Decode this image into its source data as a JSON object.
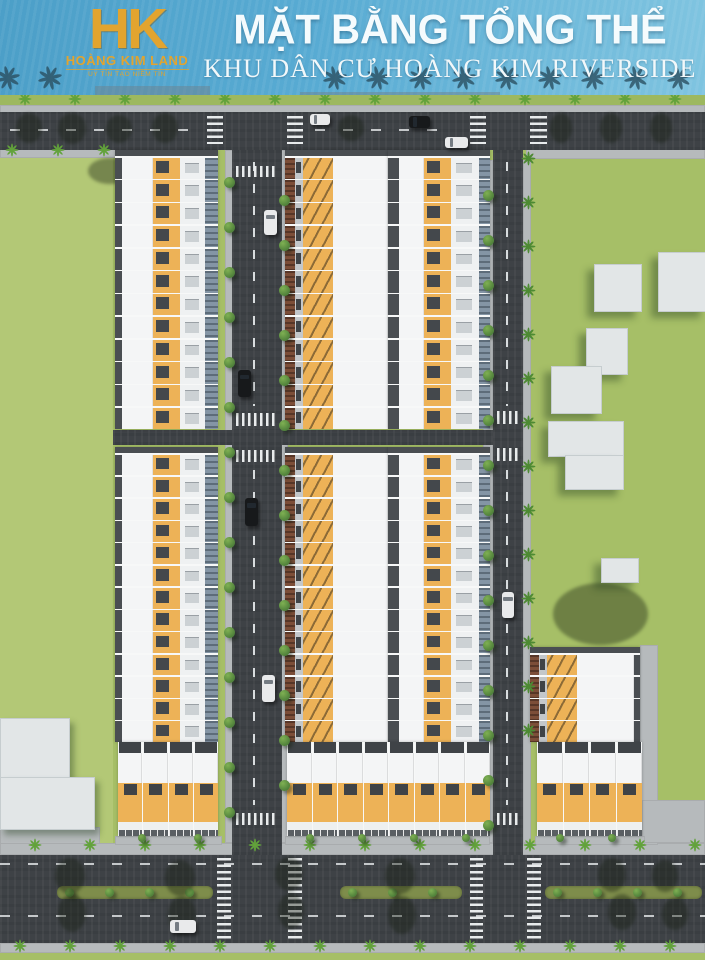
{
  "header": {
    "logo": {
      "monogram": "HK",
      "company": "HOÀNG KIM LAND",
      "tagline": "UY TÍN TẠO NIỀM TIN"
    },
    "title": "MẶT BẰNG TỔNG THỂ",
    "subtitle": "KHU DÂN CƯ HOÀNG KIM RIVERSIDE"
  },
  "palette": {
    "banner_blue": "#58abd3",
    "logo_gold": "#e2a42f",
    "title_white": "#f5fbfd",
    "grass": "#a6bf67",
    "road": "#3e4246",
    "sidewalk": "#b6babc",
    "roof_white": "#f4f5f6",
    "roof_orange": "#edb257",
    "roof_dark": "#4a4e52",
    "awning_blue": "#8495a5",
    "facade_brown": "#7c4e38",
    "building_white": "#e2e6e7",
    "median_green": "#7e8d4b",
    "tree_green": "#4d8a33",
    "car_light": "#e9eaeb",
    "car_dark": "#17191b"
  },
  "scene": {
    "grass_tints": [
      [
        0,
        95,
        705,
        12,
        "#9db85f"
      ],
      [
        0,
        158,
        113,
        686,
        "rgba(240,245,190,0.18)"
      ]
    ],
    "sidewalks": [
      [
        0,
        105,
        705,
        8
      ],
      [
        0,
        148,
        118,
        10
      ],
      [
        526,
        148,
        179,
        11
      ],
      [
        225,
        150,
        8,
        693
      ],
      [
        280,
        150,
        8,
        693
      ],
      [
        483,
        160,
        10,
        683
      ],
      [
        523,
        160,
        8,
        683
      ],
      [
        0,
        843,
        705,
        12
      ],
      [
        0,
        943,
        705,
        10
      ],
      [
        640,
        645,
        18,
        200
      ],
      [
        642,
        800,
        63,
        43
      ],
      [
        0,
        827,
        100,
        17
      ],
      [
        115,
        836,
        107,
        9
      ],
      [
        285,
        836,
        205,
        9
      ],
      [
        535,
        836,
        110,
        9
      ]
    ],
    "roads": [
      [
        0,
        112,
        705,
        38
      ],
      [
        232,
        150,
        50,
        705
      ],
      [
        493,
        150,
        30,
        705
      ],
      [
        113,
        430,
        380,
        15
      ],
      [
        0,
        855,
        705,
        88
      ]
    ],
    "medians": [
      [
        57,
        886,
        156,
        13
      ],
      [
        340,
        886,
        122,
        13
      ],
      [
        545,
        886,
        157,
        13
      ]
    ],
    "median_tree_step": 40,
    "cross_h": [
      [
        207,
        116,
        16,
        28
      ],
      [
        287,
        116,
        16,
        28
      ],
      [
        470,
        116,
        16,
        28
      ],
      [
        530,
        116,
        17,
        28
      ],
      [
        217,
        858,
        14,
        82
      ],
      [
        288,
        858,
        14,
        82
      ],
      [
        470,
        858,
        13,
        82
      ],
      [
        527,
        858,
        14,
        82
      ]
    ],
    "cross_v": [
      [
        236,
        166,
        42,
        11
      ],
      [
        236,
        413,
        42,
        13
      ],
      [
        236,
        450,
        42,
        12
      ],
      [
        236,
        813,
        42,
        12
      ],
      [
        497,
        411,
        24,
        13
      ],
      [
        497,
        448,
        24,
        13
      ],
      [
        497,
        813,
        24,
        12
      ]
    ],
    "dashes_v": [
      [
        253,
        162,
        2,
        244
      ],
      [
        253,
        470,
        2,
        335
      ],
      [
        506,
        162,
        2,
        244
      ],
      [
        506,
        470,
        2,
        335
      ]
    ],
    "dashes_h": [
      [
        10,
        129,
        190,
        2
      ],
      [
        315,
        129,
        140,
        2
      ],
      [
        0,
        863,
        705,
        2
      ],
      [
        0,
        915,
        705,
        2
      ]
    ],
    "row_kinds": {
      "faceE": [
        [
          "dark",
          7
        ],
        [
          "white",
          31
        ],
        [
          "osky",
          27
        ],
        [
          "front",
          25
        ],
        [
          "awn",
          13
        ]
      ],
      "faceW": [
        [
          "brown",
          10
        ],
        [
          "entry",
          8
        ],
        [
          "ox",
          30
        ],
        [
          "white",
          55
        ]
      ],
      "faceE2": [
        [
          "dark",
          11
        ],
        [
          "white",
          25
        ],
        [
          "osky",
          27
        ],
        [
          "front",
          28
        ],
        [
          "awn",
          11
        ]
      ],
      "faceW2": [
        [
          "brown",
          9
        ],
        [
          "entry",
          8
        ],
        [
          "ox",
          30
        ],
        [
          "white",
          57
        ],
        [
          "dark",
          6
        ]
      ]
    },
    "blocks": [
      {
        "x": 115,
        "y": 150,
        "w": 103,
        "h": 279,
        "rows": 12,
        "kind": "faceE"
      },
      {
        "x": 115,
        "y": 447,
        "w": 103,
        "h": 295,
        "rows": 13,
        "kind": "faceE"
      },
      {
        "x": 285,
        "y": 150,
        "w": 103,
        "h": 279,
        "rows": 12,
        "kind": "faceW"
      },
      {
        "x": 285,
        "y": 447,
        "w": 103,
        "h": 295,
        "rows": 13,
        "kind": "faceW"
      },
      {
        "x": 388,
        "y": 150,
        "w": 102,
        "h": 279,
        "rows": 12,
        "kind": "faceE2"
      },
      {
        "x": 388,
        "y": 447,
        "w": 102,
        "h": 295,
        "rows": 13,
        "kind": "faceE2"
      },
      {
        "x": 530,
        "y": 647,
        "w": 110,
        "h": 95,
        "rows": 4,
        "kind": "faceW2"
      }
    ],
    "south_rows": [
      {
        "x": 118,
        "y": 742,
        "w": 100,
        "houses": 4
      },
      {
        "x": 287,
        "y": 742,
        "w": 203,
        "houses": 8
      },
      {
        "x": 537,
        "y": 742,
        "w": 105,
        "houses": 4
      }
    ],
    "buildings": [
      [
        594,
        264,
        46,
        46
      ],
      [
        658,
        252,
        47,
        58
      ],
      [
        586,
        328,
        40,
        45
      ],
      [
        551,
        366,
        49,
        46
      ],
      [
        548,
        421,
        74,
        34
      ],
      [
        565,
        455,
        57,
        33
      ],
      [
        601,
        558,
        36,
        23
      ],
      [
        0,
        718,
        68,
        62
      ],
      [
        0,
        777,
        93,
        51
      ]
    ],
    "cars": [
      [
        310,
        114,
        20,
        11,
        "light"
      ],
      [
        409,
        116,
        21,
        12,
        "dark"
      ],
      [
        445,
        137,
        23,
        11,
        "light"
      ],
      [
        264,
        210,
        13,
        25,
        "light"
      ],
      [
        238,
        370,
        13,
        27,
        "dark"
      ],
      [
        245,
        498,
        13,
        28,
        "dark"
      ],
      [
        262,
        675,
        13,
        27,
        "light"
      ],
      [
        502,
        592,
        12,
        26,
        "light"
      ],
      [
        170,
        920,
        26,
        13,
        "light"
      ]
    ],
    "tree_cols": [
      [
        229,
        182,
        812,
        45,
        "round"
      ],
      [
        284,
        200,
        825,
        45,
        "round"
      ],
      [
        488,
        195,
        825,
        45,
        "round"
      ],
      [
        528,
        158,
        738,
        44,
        "palm"
      ]
    ],
    "tree_rows": [
      [
        99,
        25,
        695,
        50,
        "palm"
      ],
      [
        845,
        35,
        695,
        55,
        "palm"
      ],
      [
        946,
        20,
        700,
        50,
        "palm"
      ],
      [
        150,
        12,
        104,
        46,
        "palm"
      ]
    ],
    "front_trees": [
      [
        142,
        838
      ],
      [
        198,
        838
      ],
      [
        310,
        838
      ],
      [
        362,
        838
      ],
      [
        414,
        838
      ],
      [
        466,
        838
      ],
      [
        560,
        838
      ],
      [
        612,
        838
      ]
    ],
    "shadows": [
      [
        16,
        113,
        26,
        30
      ],
      [
        58,
        113,
        28,
        31
      ],
      [
        106,
        115,
        26,
        28
      ],
      [
        152,
        113,
        26,
        30
      ],
      [
        338,
        115,
        26,
        26
      ],
      [
        550,
        113,
        22,
        30
      ],
      [
        600,
        113,
        22,
        30
      ],
      [
        650,
        113,
        22,
        30
      ],
      [
        55,
        858,
        30,
        36
      ],
      [
        165,
        860,
        30,
        36
      ],
      [
        275,
        857,
        28,
        34
      ],
      [
        385,
        858,
        30,
        36
      ],
      [
        58,
        894,
        28,
        38
      ],
      [
        168,
        896,
        28,
        38
      ],
      [
        278,
        893,
        26,
        36
      ],
      [
        388,
        896,
        28,
        38
      ],
      [
        598,
        858,
        28,
        34
      ],
      [
        652,
        860,
        26,
        32
      ],
      [
        608,
        894,
        28,
        36
      ],
      [
        662,
        898,
        26,
        32
      ],
      [
        553,
        583,
        95,
        62
      ],
      [
        88,
        158,
        44,
        26
      ]
    ],
    "banner_palms": [
      8,
      50,
      335,
      378,
      421,
      464,
      507,
      550,
      593,
      636,
      679
    ],
    "banner_bands": [
      [
        95,
        86,
        115,
        10
      ],
      [
        300,
        92,
        200,
        14
      ],
      [
        497,
        95,
        208,
        11
      ],
      [
        0,
        104,
        705,
        8
      ]
    ]
  }
}
